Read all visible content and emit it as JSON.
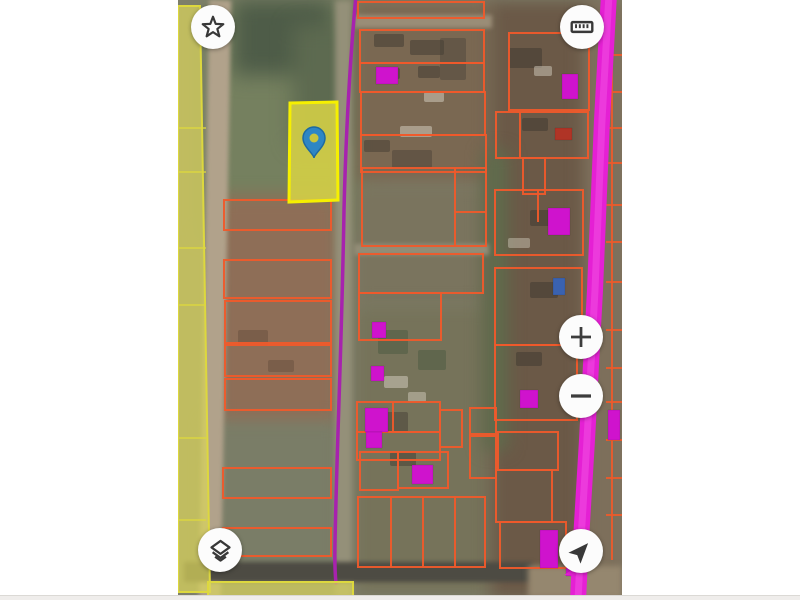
{
  "app": {
    "kind": "satellite-cadastral-map-viewer",
    "visible_text": []
  },
  "colors": {
    "page_bg": "#ffffff",
    "parcel_line": "#ef5a2b",
    "building_magenta": "#cf13cd",
    "building_red": "#b03426",
    "building_blue": "#3a62b0",
    "road_magenta": "#e520d4",
    "road_magenta_glow": "#f45ae6",
    "boundary_purple": "#a722ae",
    "highlight_fill": "#d6d146",
    "highlight_stroke": "#f6f000",
    "zone_yellow_fill": "#d9d45c",
    "zone_yellow_stroke": "#ddd83e",
    "pin_fill": "#2e86c4",
    "pin_stroke": "#1e6aa0",
    "pin_hole": "#c8c43c",
    "icon_color": "#383838",
    "button_bg": "#fcfcfc"
  },
  "controls": [
    {
      "id": "favorites",
      "icon": "star-icon"
    },
    {
      "id": "measure",
      "icon": "ruler-icon"
    },
    {
      "id": "zoom-in",
      "icon": "plus-icon"
    },
    {
      "id": "zoom-out",
      "icon": "minus-icon"
    },
    {
      "id": "layers",
      "icon": "layers-icon"
    },
    {
      "id": "locate",
      "icon": "navigation-arrow-icon"
    }
  ],
  "map": {
    "geometry": {
      "texture": [
        {
          "x": 196,
          "y": 34,
          "w": 30,
          "h": 13,
          "c": "#3e382f",
          "o": 0.5
        },
        {
          "x": 232,
          "y": 40,
          "w": 34,
          "h": 15,
          "c": "#3e382f",
          "o": 0.5
        },
        {
          "x": 262,
          "y": 38,
          "w": 26,
          "h": 42,
          "c": "#4a423a",
          "o": 0.45
        },
        {
          "x": 198,
          "y": 68,
          "w": 24,
          "h": 11,
          "c": "#3e382f",
          "o": 0.5
        },
        {
          "x": 240,
          "y": 66,
          "w": 22,
          "h": 12,
          "c": "#3e382f",
          "o": 0.5
        },
        {
          "x": 186,
          "y": 140,
          "w": 26,
          "h": 12,
          "c": "#3e382f",
          "o": 0.45
        },
        {
          "x": 214,
          "y": 150,
          "w": 40,
          "h": 18,
          "c": "#463f36",
          "o": 0.45
        },
        {
          "x": 330,
          "y": 48,
          "w": 34,
          "h": 20,
          "c": "#3e382f",
          "o": 0.5
        },
        {
          "x": 344,
          "y": 118,
          "w": 26,
          "h": 13,
          "c": "#3e382f",
          "o": 0.5
        },
        {
          "x": 352,
          "y": 210,
          "w": 30,
          "h": 16,
          "c": "#3e382f",
          "o": 0.5
        },
        {
          "x": 352,
          "y": 282,
          "w": 28,
          "h": 16,
          "c": "#3e382f",
          "o": 0.5
        },
        {
          "x": 338,
          "y": 352,
          "w": 26,
          "h": 14,
          "c": "#3e382f",
          "o": 0.5
        },
        {
          "x": 196,
          "y": 412,
          "w": 34,
          "h": 20,
          "c": "#463f36",
          "o": 0.5
        },
        {
          "x": 212,
          "y": 452,
          "w": 26,
          "h": 14,
          "c": "#3e382f",
          "o": 0.45
        },
        {
          "x": 60,
          "y": 330,
          "w": 30,
          "h": 16,
          "c": "#5c4636",
          "o": 0.4
        },
        {
          "x": 90,
          "y": 360,
          "w": 26,
          "h": 12,
          "c": "#5c4636",
          "o": 0.4
        },
        {
          "x": 200,
          "y": 330,
          "w": 30,
          "h": 24,
          "c": "#4a5a40",
          "o": 0.5
        },
        {
          "x": 240,
          "y": 350,
          "w": 28,
          "h": 20,
          "c": "#4a5a40",
          "o": 0.5
        },
        {
          "x": 222,
          "y": 126,
          "w": 32,
          "h": 11,
          "c": "#c8c1b2",
          "o": 0.6
        },
        {
          "x": 246,
          "y": 92,
          "w": 20,
          "h": 10,
          "c": "#c8c1b2",
          "o": 0.6
        },
        {
          "x": 206,
          "y": 376,
          "w": 24,
          "h": 12,
          "c": "#c8c1b2",
          "o": 0.6
        },
        {
          "x": 230,
          "y": 392,
          "w": 18,
          "h": 10,
          "c": "#c8c1b2",
          "o": 0.55
        },
        {
          "x": 356,
          "y": 66,
          "w": 18,
          "h": 10,
          "c": "#c8c1b2",
          "o": 0.55
        },
        {
          "x": 330,
          "y": 238,
          "w": 22,
          "h": 10,
          "c": "#c8c1b2",
          "o": 0.5
        }
      ],
      "parcels": [
        [
          46,
          200,
          107,
          30
        ],
        [
          46,
          260,
          107,
          38
        ],
        [
          47,
          301,
          106,
          42
        ],
        [
          47,
          345,
          106,
          31
        ],
        [
          47,
          379,
          106,
          31
        ],
        [
          45,
          468,
          108,
          30
        ],
        [
          45,
          528,
          108,
          28
        ],
        [
          180,
          2,
          126,
          16
        ],
        [
          182,
          30,
          124,
          33
        ],
        [
          182,
          63,
          124,
          29
        ],
        [
          183,
          92,
          124,
          43
        ],
        [
          183,
          135,
          125,
          37
        ],
        [
          184,
          168,
          124,
          78
        ],
        [
          181,
          254,
          124,
          39
        ],
        [
          181,
          293,
          82,
          47
        ],
        [
          179,
          402,
          83,
          30
        ],
        [
          179,
          432,
          83,
          28
        ],
        [
          262,
          410,
          22,
          37
        ],
        [
          220,
          452,
          50,
          36
        ],
        [
          182,
          452,
          38,
          38
        ],
        [
          180,
          497,
          127,
          70
        ],
        [
          292,
          408,
          26,
          26
        ],
        [
          292,
          436,
          26,
          42
        ],
        [
          331,
          33,
          80,
          77
        ],
        [
          318,
          112,
          92,
          46
        ],
        [
          345,
          158,
          22,
          36
        ],
        [
          317,
          190,
          88,
          65
        ],
        [
          317,
          268,
          87,
          77
        ],
        [
          317,
          345,
          82,
          75
        ],
        [
          320,
          432,
          60,
          38
        ],
        [
          318,
          470,
          56,
          52
        ],
        [
          322,
          522,
          66,
          46
        ]
      ],
      "dividers": [
        [
          277,
          168,
          277,
          246
        ],
        [
          277,
          212,
          308,
          212
        ],
        [
          213,
          497,
          213,
          567
        ],
        [
          245,
          497,
          245,
          567
        ],
        [
          277,
          497,
          277,
          567
        ],
        [
          215,
          402,
          215,
          432
        ],
        [
          342,
          112,
          342,
          158
        ],
        [
          360,
          190,
          360,
          222
        ]
      ],
      "right_strip": {
        "spine": [
          434,
          40,
          434,
          560
        ],
        "tick_ys": [
          55,
          92,
          128,
          163,
          205,
          242,
          282,
          330,
          368,
          402,
          440,
          478,
          515
        ],
        "tick_x1": 428,
        "tick_x2": 444
      },
      "buildings": [
        {
          "x": 198,
          "y": 67,
          "w": 22,
          "h": 17,
          "t": "magenta"
        },
        {
          "x": 194,
          "y": 322,
          "w": 14,
          "h": 16,
          "t": "magenta"
        },
        {
          "x": 193,
          "y": 366,
          "w": 13,
          "h": 15,
          "t": "magenta"
        },
        {
          "x": 187,
          "y": 408,
          "w": 23,
          "h": 24,
          "t": "magenta"
        },
        {
          "x": 188,
          "y": 432,
          "w": 16,
          "h": 16,
          "t": "magenta"
        },
        {
          "x": 234,
          "y": 465,
          "w": 21,
          "h": 19,
          "t": "magenta"
        },
        {
          "x": 384,
          "y": 74,
          "w": 16,
          "h": 25,
          "t": "magenta"
        },
        {
          "x": 370,
          "y": 208,
          "w": 22,
          "h": 27,
          "t": "magenta"
        },
        {
          "x": 342,
          "y": 390,
          "w": 18,
          "h": 18,
          "t": "magenta"
        },
        {
          "x": 362,
          "y": 530,
          "w": 18,
          "h": 38,
          "t": "magenta"
        },
        {
          "x": 430,
          "y": 410,
          "w": 12,
          "h": 30,
          "t": "magenta"
        },
        {
          "x": 388,
          "y": 568,
          "w": 12,
          "h": 8,
          "t": "magenta"
        },
        {
          "x": 377,
          "y": 128,
          "w": 17,
          "h": 12,
          "t": "red"
        },
        {
          "x": 375,
          "y": 278,
          "w": 12,
          "h": 17,
          "t": "blue"
        }
      ],
      "purple_line_d": "M178,-5 C172,60 168,130 166,210 C164,330 160,420 158,500 C157,540 156,565 158,583",
      "magenta_road_d": "M431,-6 L424,120 L417,290 L409,440 L403,540 L400,600",
      "road_arrow_points": "386,575 400,566 398,576",
      "left_zone": {
        "points": "0,6 22,6 27,300 32,592 0,592",
        "inner_lines_y": [
          128,
          172,
          248,
          305,
          438,
          520
        ]
      },
      "bottom_zone": [
        30,
        582,
        145,
        14
      ],
      "highlight_parcel_points": "112,103 159,102 160,200 111,202",
      "pin": {
        "cx": 136,
        "cy": 138,
        "r": 11,
        "tip_dy": 20,
        "hole_r": 4.5
      }
    }
  }
}
